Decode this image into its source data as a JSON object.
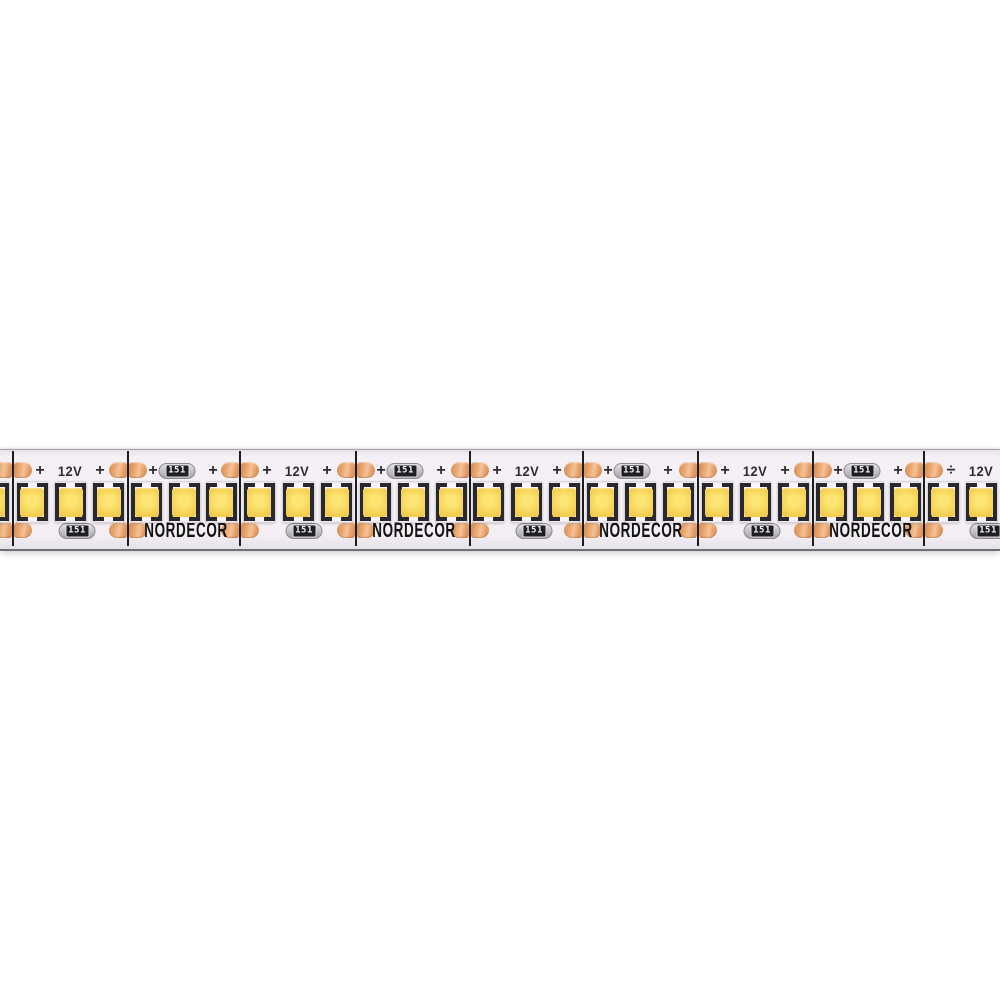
{
  "photo": {
    "background": "#ffffff",
    "subject": "LED strip light"
  },
  "strip": {
    "top": 449,
    "height": 99,
    "labels": {
      "brand": "NORDECOR",
      "voltage": "12V",
      "plus": "+",
      "plus_alt": "÷",
      "resistor": "151"
    },
    "colors": {
      "strip_bg": "#f3eff4",
      "cut_line": "#1d1d20",
      "pad_copper": "#e49b63",
      "pad_highlight": "#f4c298",
      "led_body": "#f9f6f9",
      "led_contact": "#28282d",
      "phosphor_yellow": "#f6d256",
      "resistor_body": "#c9c5cf",
      "resistor_band": "#1e1e23",
      "resistor_text": "#f2f2f2",
      "silkscreen_text": "#2d2d31",
      "brand_text": "#121212"
    },
    "cuts": [
      13,
      128,
      240,
      356,
      470,
      583,
      698,
      813,
      924
    ],
    "segment_end": 1038,
    "segments": [
      {
        "cut": 13,
        "type": "voltage"
      },
      {
        "cut": 128,
        "type": "brand"
      },
      {
        "cut": 240,
        "type": "voltage"
      },
      {
        "cut": 356,
        "type": "brand"
      },
      {
        "cut": 470,
        "type": "voltage"
      },
      {
        "cut": 583,
        "type": "brand"
      },
      {
        "cut": 698,
        "type": "voltage"
      },
      {
        "cut": 813,
        "type": "brand"
      },
      {
        "cut": 924,
        "type": "voltage",
        "plus_variant": "plus_alt"
      }
    ],
    "extra_led_centers": [
      -7
    ],
    "layout": {
      "pad_y_top": 12,
      "pad_y_bottom": 72,
      "pad_width": 18,
      "pad_gap": 1,
      "text_y_top": 21,
      "text_y_bottom": 81,
      "led_y": 31,
      "voltage_offsets": {
        "plus1": 27,
        "label": 57,
        "plus2": 87,
        "bottom_resistor": 64
      },
      "brand_offsets": {
        "plus1": 25,
        "top_resistor": 49,
        "plus2": 85,
        "bottom_brand": 58
      }
    }
  }
}
